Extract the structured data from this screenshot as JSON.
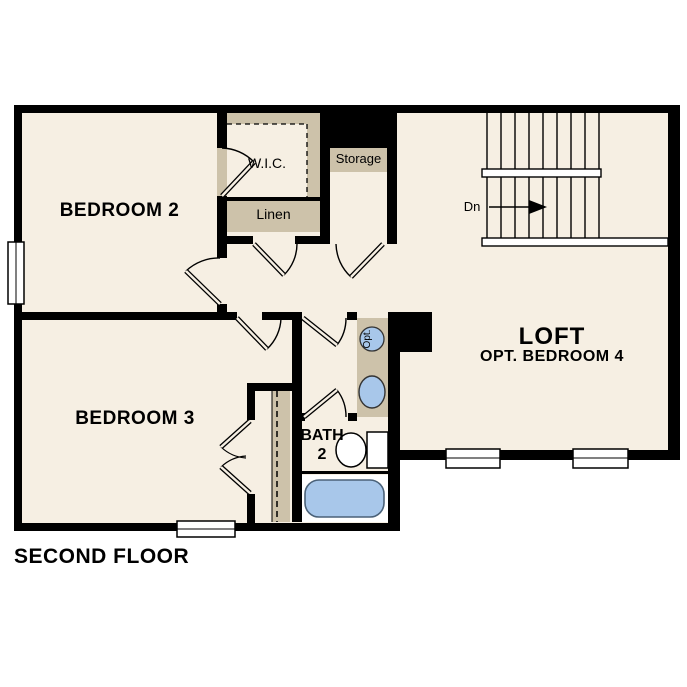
{
  "title": "SECOND FLOOR",
  "colors": {
    "background": "#ffffff",
    "floor": "#f6efe3",
    "closet_fill": "#cdc2aa",
    "wall": "#000000",
    "fixture_blue": "#a8c7ea",
    "fixture_outline": "#4a6178"
  },
  "rooms": {
    "bedroom2": {
      "label": "BEDROOM 2"
    },
    "bedroom3": {
      "label": "BEDROOM 3"
    },
    "loft": {
      "label": "LOFT",
      "sublabel": "OPT. BEDROOM 4"
    },
    "bath2": {
      "label": "BATH",
      "number": "2"
    },
    "wic": {
      "label": "W.I.C."
    },
    "linen": {
      "label": "Linen"
    },
    "storage": {
      "label": "Storage"
    }
  },
  "stairs": {
    "down_label": "Dn"
  },
  "fixtures": {
    "optional_label": "Opt."
  }
}
